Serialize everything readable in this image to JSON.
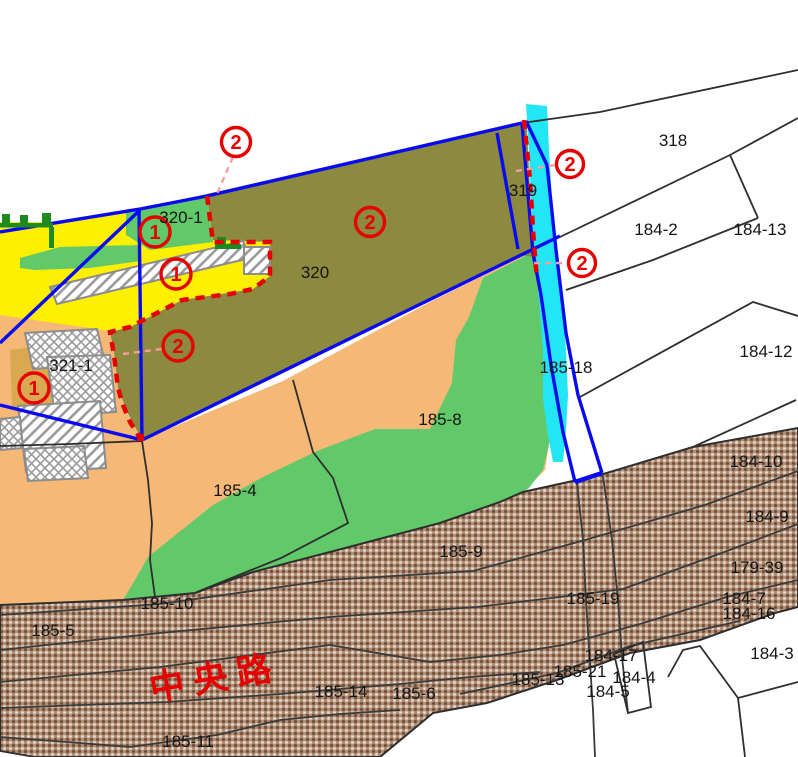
{
  "map": {
    "road_name": "中央路",
    "annotations": {
      "one": "1",
      "two": "2"
    },
    "parcels": {
      "p318": "318",
      "p319": "319",
      "p320": "320",
      "p320_1": "320-1",
      "p321_1": "321-1",
      "p184_2": "184-2",
      "p184_13": "184-13",
      "p184_12": "184-12",
      "p184_10": "184-10",
      "p184_9": "184-9",
      "p179_39": "179-39",
      "p184_7": "184-7",
      "p184_16": "184-16",
      "p184_17": "184-17",
      "p184_4": "184-4",
      "p184_5": "184-5",
      "p184_3": "184-3",
      "p185_18": "185-18",
      "p185_8": "185-8",
      "p185_4": "185-4",
      "p185_9": "185-9",
      "p185_10": "185-10",
      "p185_5": "185-5",
      "p185_19": "185-19",
      "p185_21": "185-21",
      "p185_13": "185-13",
      "p185_14": "185-14",
      "p185_6": "185-6",
      "p185_11": "185-11"
    },
    "colors": {
      "parcel_boundary_blue": "#0a0af0",
      "zone_dashed_red": "#e60000",
      "connector_pink": "#f2a0a0",
      "zone_olive": "#8b8a3e",
      "zone_yellow": "#ffef00",
      "zone_green": "#61c969",
      "zone_orange": "#f5b877",
      "zone_tan": "#d9a850",
      "stream_cyan": "#22e5f5",
      "road_brown": "#b08e76",
      "hedge_dark_green": "#1f8a1f",
      "road_name_red": "#e60000"
    }
  }
}
